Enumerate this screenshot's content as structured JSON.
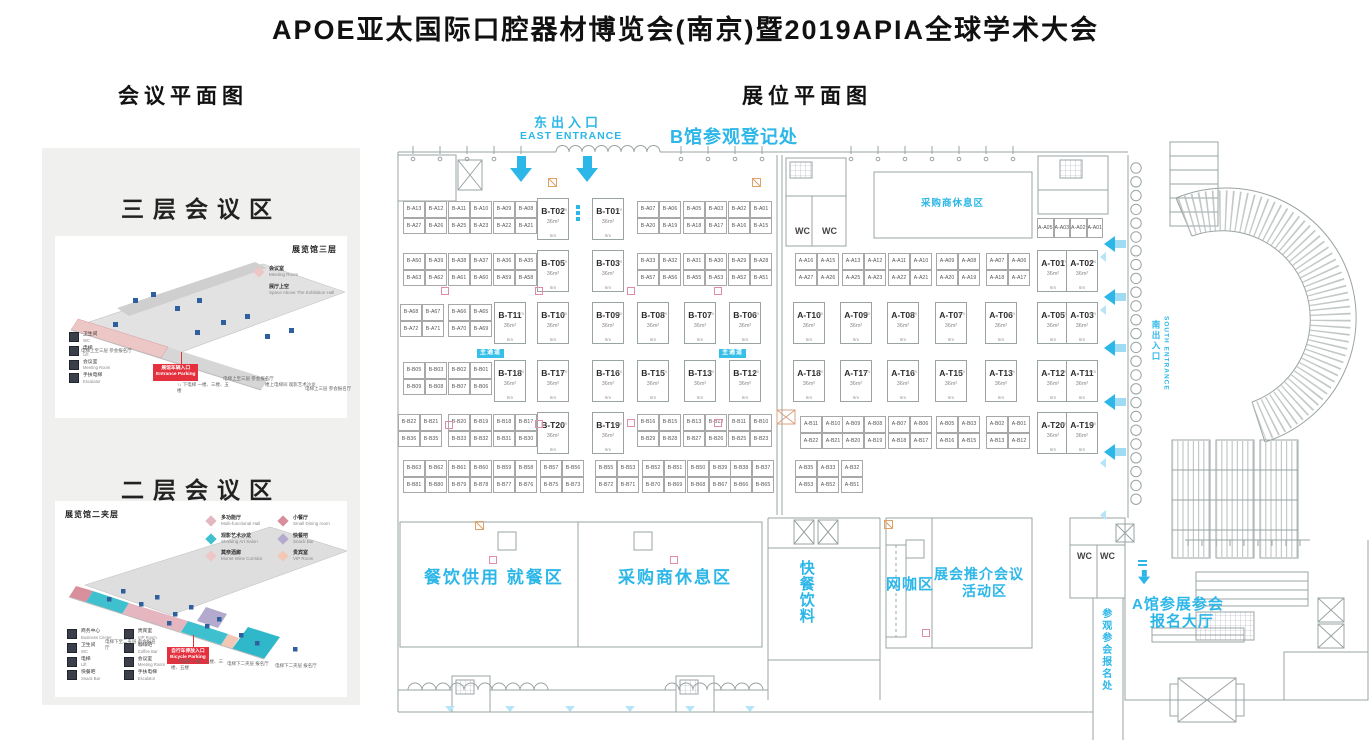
{
  "title": "APOE亚太国际口腔器材博览会(南京)暨2019APIA全球学术大会",
  "left_panel": {
    "header": "会议平面图",
    "floor3": {
      "title": "三层会议区",
      "map_label": "展览馆三层",
      "legend": [
        {
          "label": "会议室",
          "sub": "Meeting Room",
          "color": "#edc6c6"
        },
        {
          "label": "展厅上空",
          "sub": "Space Above The Exhibition Hall",
          "color": "#e2e2e2"
        }
      ],
      "icons": [
        {
          "label": "卫生间",
          "sub": "WC"
        },
        {
          "label": "电梯",
          "sub": "Lift"
        },
        {
          "label": "会议室",
          "sub": "Meeting Room"
        },
        {
          "label": "手扶电梯",
          "sub": "Escalator"
        }
      ],
      "badge": {
        "cn": "展馆车辆入口",
        "en": "Entrance Parking"
      },
      "notes": [
        {
          "t": "电梯上至三层 参会报名厅",
          "x": 26,
          "y": 112
        },
        {
          "t": "↑↓ 下电梯 一楼、三楼、五楼",
          "x": 122,
          "y": 146
        },
        {
          "t": "电梯上至三层 参会报名厅",
          "x": 168,
          "y": 140
        },
        {
          "t": "楼上电梯间 观影艺术沙龙",
          "x": 210,
          "y": 146
        },
        {
          "t": "电梯上三层 参会报名厅",
          "x": 250,
          "y": 150
        }
      ]
    },
    "floor2": {
      "title": "二层会议区",
      "map_label": "展览馆二夹层",
      "legend": [
        {
          "label": "多功能厅",
          "sub": "Multi-functional Hall",
          "color": "#e5b6c0"
        },
        {
          "label": "小餐厅",
          "sub": "Small Dining room",
          "color": "#d98f9b"
        },
        {
          "label": "观影艺术沙龙",
          "sub": "Showing Art Salon",
          "color": "#3ec0cf"
        },
        {
          "label": "快餐吧",
          "sub": "Snack Bar",
          "color": "#b3aacd"
        },
        {
          "label": "莫奈酒廊",
          "sub": "Monet Wine Corridor",
          "color": "#edc6c6"
        },
        {
          "label": "贵宾室",
          "sub": "VIP Room",
          "color": "#f2c8b4"
        }
      ],
      "icons": [
        {
          "label": "商务中心",
          "sub": "Business Center"
        },
        {
          "label": "贵宾室",
          "sub": "VIP Room"
        },
        {
          "label": "卫生间",
          "sub": "WC"
        },
        {
          "label": "咖啡吧",
          "sub": "Coffee Bar"
        },
        {
          "label": "电梯",
          "sub": "Lift"
        },
        {
          "label": "会议室",
          "sub": "Meeting Room"
        },
        {
          "label": "快餐吧",
          "sub": "Snack Bar"
        },
        {
          "label": "手扶电梯",
          "sub": "Escalator"
        }
      ],
      "badge": {
        "cn": "自行车停放入口",
        "en": "Bicycle Parking"
      },
      "notes": [
        {
          "t": "电梯下至二夹层 参会报名厅",
          "x": 50,
          "y": 138
        },
        {
          "t": "↑↓ 下电梯 一楼、二楼、三楼、五楼",
          "x": 116,
          "y": 158
        },
        {
          "t": "电梯下二夹层 报名厅",
          "x": 172,
          "y": 160
        },
        {
          "t": "电梯下二夹层 报名厅",
          "x": 220,
          "y": 162
        }
      ]
    }
  },
  "main": {
    "header": "展位平面图",
    "t_area": "36m²",
    "t_dim": "6m",
    "aisle_label": "主通道",
    "texts": [
      {
        "t": "东出入口",
        "x": 534,
        "y": 115,
        "c": "cn-entrance"
      },
      {
        "t": "EAST ENTRANCE",
        "x": 520,
        "y": 130,
        "c": "en-entrance"
      },
      {
        "t": "B馆参观登记处",
        "x": 670,
        "y": 127,
        "c": "reg-b"
      },
      {
        "t": "采购商休息区",
        "x": 921,
        "y": 198,
        "c": "area-sm"
      },
      {
        "t": "WC",
        "x": 795,
        "y": 226,
        "c": "wc"
      },
      {
        "t": "WC",
        "x": 822,
        "y": 226,
        "c": "wc"
      },
      {
        "t": "餐饮供用 就餐区",
        "x": 424,
        "y": 568,
        "c": "area-lg"
      },
      {
        "t": "采购商休息区",
        "x": 618,
        "y": 568,
        "c": "area-lg"
      },
      {
        "t": "快餐饮料",
        "x": 797,
        "y": 560,
        "c": "area-md vert"
      },
      {
        "t": "网咖区",
        "x": 886,
        "y": 576,
        "c": "area-md"
      },
      {
        "t": "展会推介会议",
        "x": 934,
        "y": 566,
        "c": "area-md2"
      },
      {
        "t": "活动区",
        "x": 962,
        "y": 583,
        "c": "area-md2"
      },
      {
        "t": "WC",
        "x": 1077,
        "y": 551,
        "c": "wc"
      },
      {
        "t": "WC",
        "x": 1100,
        "y": 551,
        "c": "wc"
      },
      {
        "t": "A馆参展参会",
        "x": 1132,
        "y": 596,
        "c": "area-md"
      },
      {
        "t": "报名大厅",
        "x": 1150,
        "y": 613,
        "c": "area-md"
      },
      {
        "t": "参观参会报名处",
        "x": 1099,
        "y": 608,
        "c": "reg-v vert"
      },
      {
        "t": "南出入口",
        "x": 1151,
        "y": 320,
        "c": "south-cn vert"
      },
      {
        "t": "SOUTH ENTRANCE",
        "x": 1162,
        "y": 316,
        "c": "south-en vert"
      }
    ],
    "quads": [
      {
        "x": 403,
        "y": 201,
        "l": [
          "B-A13",
          "B-A12",
          "B-A27",
          "B-A26"
        ]
      },
      {
        "x": 448,
        "y": 201,
        "l": [
          "B-A11",
          "B-A10",
          "B-A25",
          "B-A23"
        ]
      },
      {
        "x": 493,
        "y": 201,
        "l": [
          "B-A09",
          "B-A08",
          "B-A22",
          "B-A21"
        ]
      },
      {
        "x": 637,
        "y": 201,
        "l": [
          "B-A07",
          "B-A06",
          "B-A20",
          "B-A19"
        ]
      },
      {
        "x": 683,
        "y": 201,
        "l": [
          "B-A05",
          "B-A03",
          "B-A18",
          "B-A17"
        ]
      },
      {
        "x": 728,
        "y": 201,
        "l": [
          "B-A02",
          "B-A01",
          "B-A16",
          "B-A15"
        ]
      },
      {
        "x": 403,
        "y": 253,
        "l": [
          "B-A50",
          "B-A39",
          "B-A63",
          "B-A62"
        ]
      },
      {
        "x": 448,
        "y": 253,
        "l": [
          "B-A38",
          "B-A37",
          "B-A61",
          "B-A60"
        ]
      },
      {
        "x": 493,
        "y": 253,
        "l": [
          "B-A36",
          "B-A35",
          "B-A59",
          "B-A58"
        ]
      },
      {
        "x": 637,
        "y": 253,
        "l": [
          "B-A33",
          "B-A32",
          "B-A57",
          "B-A56"
        ]
      },
      {
        "x": 683,
        "y": 253,
        "l": [
          "B-A31",
          "B-A30",
          "B-A55",
          "B-A53"
        ]
      },
      {
        "x": 728,
        "y": 253,
        "l": [
          "B-A29",
          "B-A28",
          "B-A52",
          "B-A51"
        ]
      },
      {
        "x": 795,
        "y": 253,
        "l": [
          "A-A16",
          "A-A15",
          "A-A27",
          "A-A26"
        ]
      },
      {
        "x": 842,
        "y": 253,
        "l": [
          "A-A13",
          "A-A12",
          "A-A25",
          "A-A23"
        ]
      },
      {
        "x": 888,
        "y": 253,
        "l": [
          "A-A11",
          "A-A10",
          "A-A22",
          "A-A21"
        ]
      },
      {
        "x": 936,
        "y": 253,
        "l": [
          "A-A09",
          "A-A08",
          "A-A20",
          "A-A19"
        ]
      },
      {
        "x": 986,
        "y": 253,
        "l": [
          "A-A07",
          "A-A06",
          "A-A18",
          "A-A17"
        ]
      },
      {
        "x": 400,
        "y": 304,
        "l": [
          "B-A68",
          "B-A67",
          "B-A72",
          "B-A71"
        ]
      },
      {
        "x": 448,
        "y": 304,
        "l": [
          "B-A66",
          "B-A65",
          "B-A70",
          "B-A69"
        ]
      },
      {
        "x": 403,
        "y": 362,
        "l": [
          "B-B05",
          "B-B03",
          "B-B09",
          "B-B08"
        ]
      },
      {
        "x": 448,
        "y": 362,
        "l": [
          "B-B02",
          "B-B01",
          "B-B07",
          "B-B06"
        ]
      },
      {
        "x": 398,
        "y": 414,
        "l": [
          "B-B22",
          "B-B21",
          "B-B36",
          "B-B35"
        ]
      },
      {
        "x": 448,
        "y": 414,
        "l": [
          "B-B20",
          "B-B19",
          "B-B33",
          "B-B32"
        ]
      },
      {
        "x": 493,
        "y": 414,
        "l": [
          "B-B18",
          "B-B17",
          "B-B31",
          "B-B30"
        ]
      },
      {
        "x": 637,
        "y": 414,
        "l": [
          "B-B16",
          "B-B15",
          "B-B29",
          "B-B28"
        ]
      },
      {
        "x": 683,
        "y": 414,
        "l": [
          "B-B13",
          "B-B12",
          "B-B27",
          "B-B26"
        ]
      },
      {
        "x": 728,
        "y": 414,
        "l": [
          "B-B11",
          "B-B10",
          "B-B25",
          "B-B23"
        ]
      },
      {
        "x": 800,
        "y": 416,
        "l": [
          "A-B11",
          "A-B10",
          "A-B22",
          "A-B21"
        ]
      },
      {
        "x": 842,
        "y": 416,
        "l": [
          "A-B09",
          "A-B08",
          "A-B20",
          "A-B19"
        ]
      },
      {
        "x": 888,
        "y": 416,
        "l": [
          "A-B07",
          "A-B06",
          "A-B18",
          "A-B17"
        ]
      },
      {
        "x": 936,
        "y": 416,
        "l": [
          "A-B05",
          "A-B03",
          "A-B16",
          "A-B15"
        ]
      },
      {
        "x": 986,
        "y": 416,
        "l": [
          "A-B02",
          "A-B01",
          "A-B13",
          "A-B12"
        ]
      },
      {
        "x": 403,
        "y": 460,
        "l": [
          "B-B63",
          "B-B62",
          "B-B81",
          "B-B80"
        ]
      },
      {
        "x": 448,
        "y": 460,
        "l": [
          "B-B61",
          "B-B60",
          "B-B79",
          "B-B78"
        ]
      },
      {
        "x": 493,
        "y": 460,
        "l": [
          "B-B59",
          "B-B58",
          "B-B77",
          "B-B76"
        ]
      },
      {
        "x": 540,
        "y": 460,
        "l": [
          "B-B57",
          "B-B56",
          "B-B75",
          "B-B73"
        ]
      },
      {
        "x": 595,
        "y": 460,
        "l": [
          "B-B55",
          "B-B53",
          "B-B72",
          "B-B71"
        ]
      },
      {
        "x": 642,
        "y": 460,
        "l": [
          "B-B52",
          "B-B51",
          "B-B70",
          "B-B69"
        ]
      },
      {
        "x": 687,
        "y": 460,
        "l": [
          "B-B50",
          "B-B39",
          "B-B68",
          "B-B67"
        ]
      },
      {
        "x": 730,
        "y": 460,
        "l": [
          "B-B38",
          "B-B37",
          "B-B66",
          "B-B65"
        ]
      },
      {
        "x": 795,
        "y": 460,
        "l": [
          "A-B35",
          "A-B33",
          "A-B53",
          "A-B52"
        ]
      }
    ],
    "t_booths": [
      {
        "id": "B-T02",
        "x": 537,
        "y": 198
      },
      {
        "id": "B-T01",
        "x": 592,
        "y": 198
      },
      {
        "id": "B-T05",
        "x": 537,
        "y": 250
      },
      {
        "id": "B-T03",
        "x": 592,
        "y": 250
      },
      {
        "id": "B-T11",
        "x": 494,
        "y": 302
      },
      {
        "id": "B-T10",
        "x": 537,
        "y": 302
      },
      {
        "id": "B-T09",
        "x": 592,
        "y": 302
      },
      {
        "id": "B-T08",
        "x": 637,
        "y": 302
      },
      {
        "id": "B-T07",
        "x": 684,
        "y": 302
      },
      {
        "id": "B-T06",
        "x": 729,
        "y": 302
      },
      {
        "id": "A-T10",
        "x": 793,
        "y": 302
      },
      {
        "id": "A-T09",
        "x": 840,
        "y": 302
      },
      {
        "id": "A-T08",
        "x": 887,
        "y": 302
      },
      {
        "id": "A-T07",
        "x": 935,
        "y": 302
      },
      {
        "id": "A-T06",
        "x": 985,
        "y": 302
      },
      {
        "id": "B-T18",
        "x": 494,
        "y": 360
      },
      {
        "id": "B-T17",
        "x": 537,
        "y": 360
      },
      {
        "id": "B-T16",
        "x": 592,
        "y": 360
      },
      {
        "id": "B-T15",
        "x": 637,
        "y": 360
      },
      {
        "id": "B-T13",
        "x": 684,
        "y": 360
      },
      {
        "id": "B-T12",
        "x": 729,
        "y": 360
      },
      {
        "id": "A-T18",
        "x": 793,
        "y": 360
      },
      {
        "id": "A-T17",
        "x": 840,
        "y": 360
      },
      {
        "id": "A-T16",
        "x": 887,
        "y": 360
      },
      {
        "id": "A-T15",
        "x": 935,
        "y": 360
      },
      {
        "id": "A-T13",
        "x": 985,
        "y": 360
      },
      {
        "id": "B-T20",
        "x": 537,
        "y": 412
      },
      {
        "id": "B-T19",
        "x": 592,
        "y": 412
      }
    ],
    "t_pairs": [
      {
        "ids": [
          "A-T01",
          "A-T02"
        ],
        "x": 1037,
        "y": 250
      },
      {
        "ids": [
          "A-T05",
          "A-T03"
        ],
        "x": 1037,
        "y": 302
      },
      {
        "ids": [
          "A-T12",
          "A-T11"
        ],
        "x": 1037,
        "y": 360
      },
      {
        "ids": [
          "A-T20",
          "A-T19"
        ],
        "x": 1037,
        "y": 412
      }
    ],
    "strips": [
      {
        "x": 1037,
        "y": 218,
        "labels": [
          "A-A05",
          "A-A03",
          "A-A02",
          "A-A01"
        ]
      }
    ],
    "halfs": [
      {
        "x": 841,
        "y": 460,
        "labels": [
          "A-B32",
          "A-B51"
        ]
      }
    ],
    "chips": [
      {
        "x": 477,
        "y": 349
      },
      {
        "x": 719,
        "y": 349
      }
    ],
    "arrow_left_x": 1104,
    "arrows_left": [
      236,
      289,
      340,
      394,
      444
    ],
    "arrow_down_y": 156,
    "arrows_down": [
      510,
      576
    ],
    "arrow_small": {
      "x": 1138,
      "y": 560
    },
    "pink_squares": [
      [
        441,
        287
      ],
      [
        535,
        287
      ],
      [
        627,
        287
      ],
      [
        714,
        287
      ],
      [
        445,
        421
      ],
      [
        535,
        420
      ],
      [
        627,
        419
      ],
      [
        714,
        419
      ],
      [
        489,
        556
      ],
      [
        670,
        556
      ],
      [
        922,
        629
      ]
    ],
    "orange_squares": [
      [
        548,
        178
      ],
      [
        752,
        178
      ],
      [
        475,
        521
      ],
      [
        884,
        520
      ]
    ],
    "tri_down_y": 706,
    "tri_down": [
      445,
      505,
      565,
      625,
      685,
      745
    ],
    "tri_left": [
      [
        1100,
        252
      ],
      [
        1100,
        305
      ],
      [
        1100,
        458
      ],
      [
        1100,
        510
      ]
    ],
    "colors": {
      "cyan": "#2cb7e8",
      "badge_red": "#e5303e",
      "line": "#9aa3a3"
    }
  }
}
